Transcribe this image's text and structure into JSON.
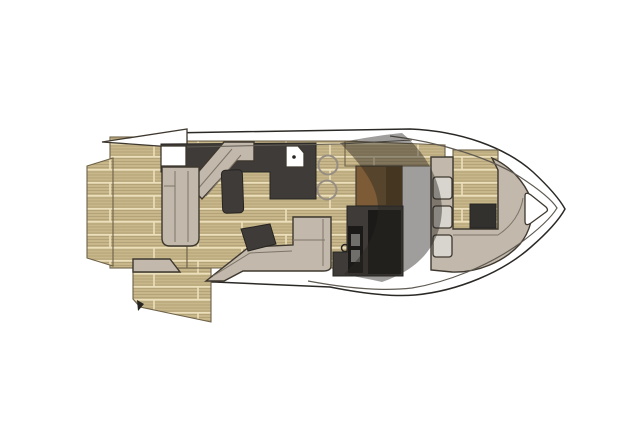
{
  "canvas": {
    "width": 637,
    "height": 425,
    "background": "#ffffff"
  },
  "diagram": {
    "type": "yacht-deck-plan",
    "view": "top-down floor plan",
    "orientation": "bow-right"
  },
  "colors": {
    "teak_base": "#c8b78a",
    "teak_seam": "#ecdfbc",
    "teak_grain": "#8f7c55",
    "teak_edge": "#6d6148",
    "taupe": "#c2b8ab",
    "furniture_outline": "#3e382f",
    "furniture_line": "#7d7568",
    "charcoal": "#3e3b38",
    "charcoal_dark": "#262421",
    "black_unit": "#1b1a18",
    "brown": "#7d5b36",
    "brown_dark": "#5c431f",
    "hull_white": "#ffffff",
    "hull_stroke": "#2b2926",
    "sheer_line": "#5f5a52",
    "gray_cushion": "#d8d4ce",
    "sink_white": "#ffffff",
    "stool_ring": "#968e83",
    "table_black": "#33312e",
    "slot_gray": "#716f6c",
    "glass": "rgba(43,40,36,0.45)"
  },
  "regions": [
    {
      "name": "hull-outline",
      "label": "hull with pointed bow to the right"
    },
    {
      "name": "swim-platform-extension",
      "label": "small teak platform tab at stern"
    },
    {
      "name": "swim-platform",
      "label": "teak swim platform / aft deck"
    },
    {
      "name": "lower-swim-platform",
      "label": "angled lowered teak platform, bottom left"
    },
    {
      "name": "hardtop-overhang",
      "label": "white hardtop wedge over stern corner"
    },
    {
      "name": "transom-hatch",
      "label": "white deck hatch in cockpit"
    },
    {
      "name": "cockpit-settee",
      "label": "L-shaped cockpit settee"
    },
    {
      "name": "cockpit-stairs",
      "label": "diagonal steps to side deck"
    },
    {
      "name": "cockpit-sunpad",
      "label": "dark pad in cockpit"
    },
    {
      "name": "galley-counter",
      "label": "charcoal galley counter band"
    },
    {
      "name": "galley-sink",
      "label": "white sink with faucet dot"
    },
    {
      "name": "bar-stools",
      "label": "two round teak stools"
    },
    {
      "name": "salon-settee",
      "label": "L-shaped settee amidships"
    },
    {
      "name": "settee-cushion",
      "label": "dark corner cushion"
    },
    {
      "name": "helm-dashboard",
      "label": "brown helm dashboard"
    },
    {
      "name": "helm-console",
      "label": "charcoal helm console and companionway"
    },
    {
      "name": "windshield-glass",
      "label": "curved tinted windshield overlay"
    },
    {
      "name": "bow-lounge",
      "label": "U-shaped bow lounge seating"
    },
    {
      "name": "bow-cushions",
      "label": "three gray seat cushions"
    },
    {
      "name": "bow-table",
      "label": "dark bow table"
    },
    {
      "name": "bow-deck-teak",
      "label": "teak pocket inside bow lounge"
    },
    {
      "name": "anchor-locker-hatch",
      "label": "triangular hatch at bow tip"
    }
  ]
}
